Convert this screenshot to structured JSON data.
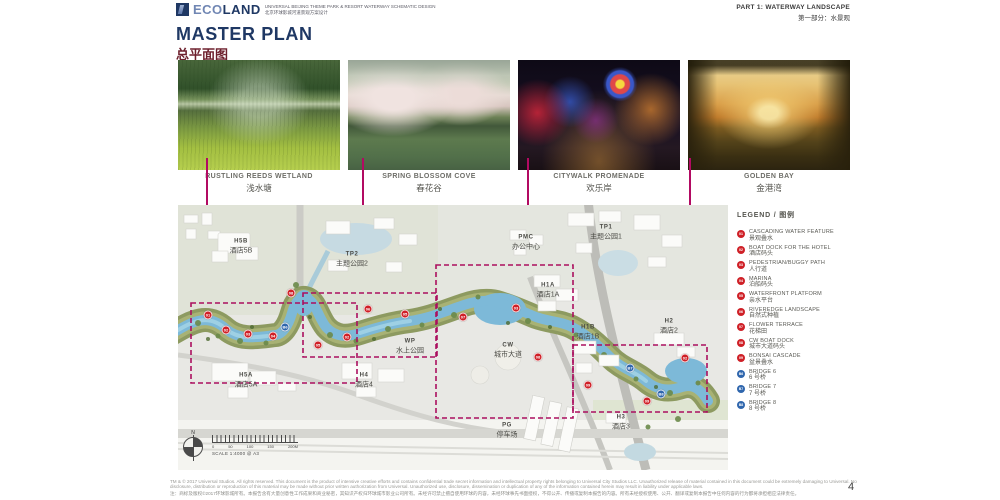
{
  "colors": {
    "accent_magenta": "#b20a62",
    "navy": "#1f3864",
    "title_red": "#6d1f2c",
    "marker_red": "#cf2027",
    "marker_blue": "#2f66ad",
    "river_blue": "#7db9d8"
  },
  "header": {
    "logo_eco": "ECO",
    "logo_land": "LAND",
    "logo_sub_en": "UNIVERSAL BEIJING THEME PARK & RESORT WATERWAY SCHEMATIC DESIGN",
    "logo_sub_zh": "北京环球影城河道景观方案设计",
    "part_en": "PART 1: WATERWAY LANDSCAPE",
    "part_zh": "第一部分：水景观",
    "title_en": "MASTER PLAN",
    "title_zh": "总平面图"
  },
  "photos": [
    {
      "name_en": "RUSTLING REEDS WETLAND",
      "name_zh": "浅水塘"
    },
    {
      "name_en": "SPRING BLOSSOM COVE",
      "name_zh": "春花谷"
    },
    {
      "name_en": "CITYWALK PROMENADE",
      "name_zh": "欢乐岸"
    },
    {
      "name_en": "GOLDEN BAY",
      "name_zh": "金港湾"
    }
  ],
  "map": {
    "labels": [
      {
        "code": "H5B",
        "zh": "酒店5B",
        "x": 63,
        "y": 42
      },
      {
        "code": "TP2",
        "zh": "主题公园2",
        "x": 174,
        "y": 55
      },
      {
        "code": "PMC",
        "zh": "办公中心",
        "x": 348,
        "y": 38
      },
      {
        "code": "TP1",
        "zh": "主题公园1",
        "x": 428,
        "y": 28
      },
      {
        "code": "H1A",
        "zh": "酒店1A",
        "x": 370,
        "y": 86
      },
      {
        "code": "H1B",
        "zh": "酒店1B",
        "x": 410,
        "y": 128
      },
      {
        "code": "H2",
        "zh": "酒店2",
        "x": 491,
        "y": 122
      },
      {
        "code": "WP",
        "zh": "水上公园",
        "x": 232,
        "y": 142
      },
      {
        "code": "CW",
        "zh": "城市大道",
        "x": 330,
        "y": 146
      },
      {
        "code": "H5A",
        "zh": "酒店5A",
        "x": 68,
        "y": 176
      },
      {
        "code": "H4",
        "zh": "酒店4",
        "x": 186,
        "y": 176
      },
      {
        "code": "PG",
        "zh": "停车场",
        "x": 329,
        "y": 226
      },
      {
        "code": "H3",
        "zh": "酒店3",
        "x": 443,
        "y": 218
      }
    ],
    "markers": [
      {
        "num": "01",
        "kind": "red",
        "x": 30,
        "y": 110
      },
      {
        "num": "02",
        "kind": "red",
        "x": 48,
        "y": 125
      },
      {
        "num": "03",
        "kind": "red",
        "x": 70,
        "y": 129
      },
      {
        "num": "04",
        "kind": "red",
        "x": 95,
        "y": 131
      },
      {
        "num": "08",
        "kind": "red",
        "x": 113,
        "y": 88
      },
      {
        "num": "05",
        "kind": "red",
        "x": 140,
        "y": 140
      },
      {
        "num": "02",
        "kind": "red",
        "x": 169,
        "y": 132
      },
      {
        "num": "06",
        "kind": "red",
        "x": 190,
        "y": 104
      },
      {
        "num": "05",
        "kind": "red",
        "x": 227,
        "y": 109
      },
      {
        "num": "07",
        "kind": "red",
        "x": 285,
        "y": 112
      },
      {
        "num": "03",
        "kind": "red",
        "x": 338,
        "y": 103
      },
      {
        "num": "08",
        "kind": "red",
        "x": 360,
        "y": 152
      },
      {
        "num": "09",
        "kind": "red",
        "x": 410,
        "y": 180
      },
      {
        "num": "02",
        "kind": "red",
        "x": 507,
        "y": 153
      },
      {
        "num": "09",
        "kind": "red",
        "x": 469,
        "y": 196
      },
      {
        "num": "B6",
        "kind": "blue",
        "x": 107,
        "y": 122
      },
      {
        "num": "B7",
        "kind": "blue",
        "x": 452,
        "y": 163
      },
      {
        "num": "B8",
        "kind": "blue",
        "x": 483,
        "y": 189
      }
    ],
    "north_label": "N",
    "scale_label": "SCALE 1:4000 @ A3",
    "scale_ticks": [
      {
        "t": "0"
      },
      {
        "t": "50"
      },
      {
        "t": "100"
      },
      {
        "t": "150"
      },
      {
        "t": "200M"
      }
    ]
  },
  "legend": {
    "title": "LEGEND / 图例",
    "items": [
      {
        "num": "01",
        "kind": "red",
        "en": "CASCADING WATER FEATURE",
        "zh": "景观叠水"
      },
      {
        "num": "02",
        "kind": "red",
        "en": "BOAT DOCK FOR THE HOTEL",
        "zh": "酒店码头"
      },
      {
        "num": "03",
        "kind": "red",
        "en": "PEDESTRIAN/BUGGY PATH",
        "zh": "人行道"
      },
      {
        "num": "04",
        "kind": "red",
        "en": "MARINA",
        "zh": "泊船码头"
      },
      {
        "num": "05",
        "kind": "red",
        "en": "WATERFRONT PLATFORM",
        "zh": "亲水平台"
      },
      {
        "num": "06",
        "kind": "red",
        "en": "RIVEREDGE LANDSCAPE",
        "zh": "自然式种植"
      },
      {
        "num": "07",
        "kind": "red",
        "en": "FLOWER TERRACE",
        "zh": "花梯田"
      },
      {
        "num": "08",
        "kind": "red",
        "en": "CW BOAT DOCK",
        "zh": "城市大道码头"
      },
      {
        "num": "09",
        "kind": "red",
        "en": "BONSAI CASCADE",
        "zh": "盆景叠水"
      },
      {
        "num": "B6",
        "kind": "blue",
        "en": "BRIDGE 6",
        "zh": "6 号桥"
      },
      {
        "num": "B7",
        "kind": "blue",
        "en": "BRIDGE 7",
        "zh": "7 号桥"
      },
      {
        "num": "B8",
        "kind": "blue",
        "en": "BRIDGE 8",
        "zh": "8 号桥"
      }
    ]
  },
  "footer": {
    "en_line1": "TM & © 2017 Universal Studios. All rights reserved. This document is the product of intensive creative efforts and contains confidential trade secret information and intellectual property rights belonging to Universal City Studios LLC. Unauthorized release of material contained in this document could be extremely damaging to Universal. No",
    "en_line2": "disclosure, distribution or reproduction of this material may be made without prior written authorization from Universal. Unauthorized use, disclosure, dissemination or duplication of any of the information contained herein may result in liability under applicable laws.",
    "zh_line": "注：商标及版权©2017环球影城所有。本报告含有大量创意性工作成果和商业秘密，其知识产权归环球城市影业公司所有。未经许可禁止擅自使用环球的内容，未经环球事先书面授权，不得公开、传播或复制本报告的内容。所有未经授权使用、公开、翻译或复制本报告中任何内容的行为都将承担相应法律责任。",
    "page_number": "4"
  }
}
